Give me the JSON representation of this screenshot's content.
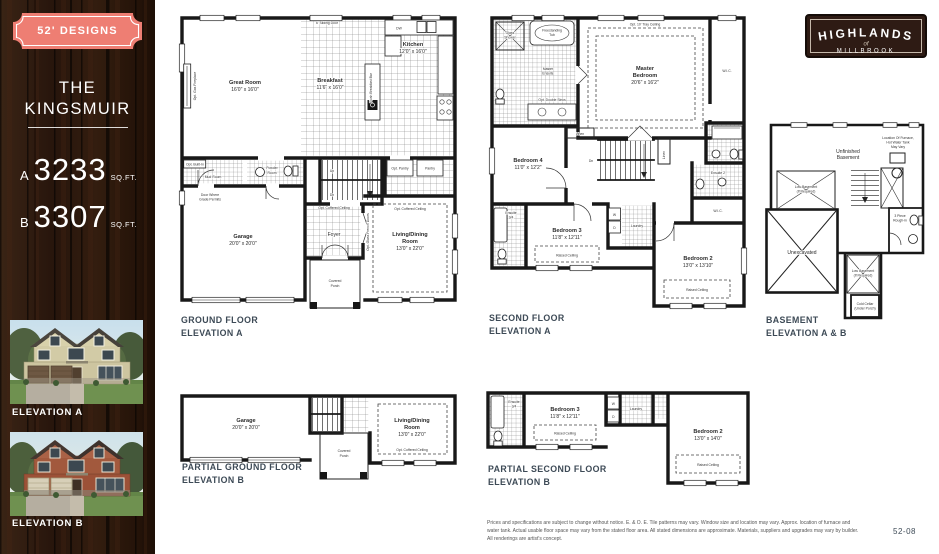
{
  "sidebar": {
    "badge_label": "52' DESIGNS",
    "title_line1": "THE",
    "title_line2": "KINGSMUIR",
    "plan_a_letter": "A",
    "plan_a_sqft": "3233",
    "plan_a_unit": "SQ.FT.",
    "plan_b_letter": "B",
    "plan_b_sqft": "3307",
    "plan_b_unit": "SQ.FT.",
    "elevation_a_label": "ELEVATION A",
    "elevation_b_label": "ELEVATION B"
  },
  "logo": {
    "name": "HIGHLANDS",
    "of": "of",
    "place": "MILLBROOK"
  },
  "captions": {
    "ground_a_1": "GROUND FLOOR",
    "ground_a_2": "ELEVATION A",
    "second_a_1": "SECOND FLOOR",
    "second_a_2": "ELEVATION A",
    "basement_1": "BASEMENT",
    "basement_2": "ELEVATION A & B",
    "partial_ground_b_1": "PARTIAL GROUND FLOOR",
    "partial_ground_b_2": "ELEVATION B",
    "partial_second_b_1": "PARTIAL SECOND FLOOR",
    "partial_second_b_2": "ELEVATION B"
  },
  "common": {
    "raised_ceiling": "Raised Ceiling",
    "opt_coffered": "Opt. Coffered Ceiling",
    "wic": "W.I.C.",
    "linen": "Linen",
    "up": "Up",
    "dn": "Dn",
    "w": "W",
    "d": "D",
    "laundry": "Laundry",
    "ensuite34_1": "Ensuite",
    "ensuite34_2": "3/4"
  },
  "ground_a": {
    "great_room": "Great Room",
    "great_room_dims": "16'0\" x 16'0\"",
    "kitchen": "Kitchen",
    "kitchen_dims": "12'0\" x 16'0\"",
    "breakfast": "Breakfast",
    "breakfast_dims": "11'6\" x 16'0\"",
    "garage": "Garage",
    "garage_dims": "20'0\" x 20'0\"",
    "living_1": "Living/Dining",
    "living_2": "Room",
    "living_dims": "13'0\" x 22'0\"",
    "foyer": "Foyer",
    "covered_1": "Covered",
    "covered_2": "Porch",
    "powder_1": "Powder",
    "powder_2": "Room",
    "mud_room": "Mud Room",
    "opt_built_in": "Opt. Built-In",
    "opt_gas_fireplace": "Opt. Gas Fireplace",
    "dw": "DW",
    "sliding_door": "6' Sliding Door",
    "opt_pantry": "Opt. Pantry",
    "pantry": "Pantry",
    "island": "Flush Breakfast Bar",
    "french_doors": "Opt. Glass French Doors",
    "door_grade_1": "Door Where",
    "door_grade_2": "Grade Permits"
  },
  "second_a": {
    "master_1": "Master",
    "master_2": "Bedroom",
    "master_dims": "20'6\" x 16'2\"",
    "tray": "Opt. 10' Tray Ceiling",
    "bedroom4": "Bedroom 4",
    "bedroom4_dims": "11'0\" x 12'2\"",
    "bedroom3": "Bedroom 3",
    "bedroom3_dims": "11'8\" x 12'11\"",
    "bedroom2": "Bedroom 2",
    "bedroom2_dims": "13'0\" x 13'10\"",
    "ensuite_1": "Master",
    "ensuite_2": "Ensuite",
    "shower_1": "Glass",
    "shower_2": "Shower",
    "tub_1": "Freestanding",
    "tub_2": "Tub",
    "double_sinks": "Opt. Double Sinks",
    "ensuite2": "Ensuite 2"
  },
  "basement": {
    "unfinished_1": "Unfinished",
    "unfinished_2": "Basement",
    "unexcavated": "Unexcavated",
    "low_1": "Low Basement",
    "low_2": "(If Required)",
    "cold_1": "Cold Cellar",
    "cold_2": "(Under Porch)",
    "rough_1": "3 Piece",
    "rough_2": "Rough-in",
    "furnace_1": "Location Of Furnace,",
    "furnace_2": "Hot Water Tank",
    "furnace_3": "May Vary"
  },
  "partial_second_b": {
    "bedroom2_dims": "13'0\" x 14'0\""
  },
  "footer": {
    "disclaimer": "Prices and specifications are subject to change without notice. E. & O. E. Tile patterns may vary. Window size and location may vary. Approx. location of furnace and water tank. Actual usable floor space may vary from the stated floor area. All stated dimensions are approximate. Materials, suppliers and upgrades may vary by builder. All renderings are artist's concept.",
    "page_number": "52-08"
  }
}
